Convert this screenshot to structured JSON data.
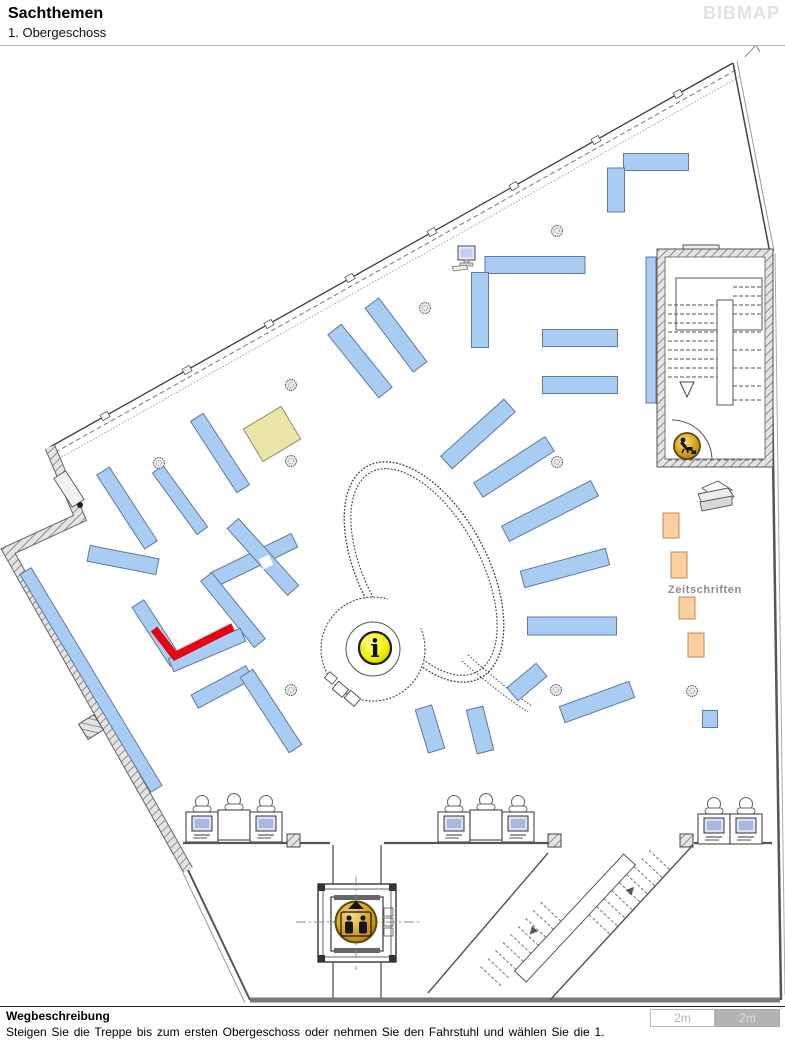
{
  "header": {
    "title": "Sachthemen",
    "subtitle": "1. Obergeschoss",
    "logo": "BIBMAP"
  },
  "footer": {
    "heading": "Wegbeschreibung",
    "instruction": "Steigen Sie die Treppe bis zum ersten Obergeschoss oder nehmen Sie den Fahrstuhl und wählen Sie die 1.",
    "scale_left": "2m",
    "scale_right": "2m"
  },
  "map": {
    "zeitschriften_label": "Zeitschriften",
    "info_glyph": "i",
    "colors": {
      "shelf_fill": "#a9cdf2",
      "shelf_stroke": "#61799c",
      "highlight_red": "#e30613",
      "magazine_fill": "#fbcf9e",
      "special_fill": "#ece5a8",
      "icon_gold": "#d9a61f",
      "info_yellow": "#f0ea00"
    },
    "icons": {
      "info": "info-icon",
      "elevator": "elevator-icon",
      "stairs_person": "person-on-stairs-icon",
      "printer": "copier-icon",
      "computer": "computer-icon"
    },
    "shelves": [
      {
        "x": 220,
        "y": 453,
        "l": 85,
        "w": 15,
        "a": 57
      },
      {
        "x": 127,
        "y": 508,
        "l": 88,
        "w": 15,
        "a": 57
      },
      {
        "x": 123,
        "y": 560,
        "l": 70,
        "w": 16,
        "a": 11
      },
      {
        "x": 180,
        "y": 500,
        "l": 76,
        "w": 13,
        "a": 54
      },
      {
        "x": 254,
        "y": 560,
        "l": 90,
        "w": 15,
        "a": -26
      },
      {
        "x": 263,
        "y": 557,
        "l": 90,
        "w": 15,
        "a": 48
      },
      {
        "x": 233,
        "y": 610,
        "l": 85,
        "w": 14,
        "a": 51
      },
      {
        "x": 157,
        "y": 633,
        "l": 70,
        "w": 14,
        "a": 57
      },
      {
        "x": 207,
        "y": 650,
        "l": 78,
        "w": 14,
        "a": -23
      },
      {
        "x": 222,
        "y": 687,
        "l": 62,
        "w": 15,
        "a": -28
      },
      {
        "x": 271,
        "y": 711,
        "l": 90,
        "w": 15,
        "a": 57
      },
      {
        "x": 91,
        "y": 680,
        "l": 254,
        "w": 13,
        "a": 59
      },
      {
        "x": 656,
        "y": 162,
        "l": 65,
        "w": 17,
        "a": 0
      },
      {
        "x": 616,
        "y": 190,
        "l": 44,
        "w": 17,
        "a": 90
      },
      {
        "x": 535,
        "y": 265,
        "l": 100,
        "w": 17,
        "a": 0
      },
      {
        "x": 480,
        "y": 310,
        "l": 75,
        "w": 17,
        "a": 90
      },
      {
        "x": 580,
        "y": 338,
        "l": 75,
        "w": 17,
        "a": 0
      },
      {
        "x": 580,
        "y": 385,
        "l": 75,
        "w": 17,
        "a": 0
      },
      {
        "x": 651,
        "y": 330,
        "l": 146,
        "w": 10,
        "a": 90
      },
      {
        "x": 360,
        "y": 361,
        "l": 81,
        "w": 17,
        "a": 51
      },
      {
        "x": 396,
        "y": 335,
        "l": 80,
        "w": 17,
        "a": 53
      },
      {
        "x": 478,
        "y": 434,
        "l": 85,
        "w": 17,
        "a": -42
      },
      {
        "x": 514,
        "y": 467,
        "l": 85,
        "w": 17,
        "a": -33
      },
      {
        "x": 550,
        "y": 511,
        "l": 100,
        "w": 17,
        "a": -27
      },
      {
        "x": 565,
        "y": 568,
        "l": 88,
        "w": 17,
        "a": -15
      },
      {
        "x": 572,
        "y": 626,
        "l": 89,
        "w": 18,
        "a": 0
      },
      {
        "x": 527,
        "y": 682,
        "l": 38,
        "w": 17,
        "a": -40
      },
      {
        "x": 597,
        "y": 702,
        "l": 74,
        "w": 17,
        "a": -20
      },
      {
        "x": 430,
        "y": 729,
        "l": 45,
        "w": 17,
        "a": 73
      },
      {
        "x": 480,
        "y": 730,
        "l": 45,
        "w": 17,
        "a": 76
      },
      {
        "x": 710,
        "y": 719,
        "l": 15,
        "w": 17,
        "a": 0
      }
    ],
    "special_shelves": [
      {
        "x": 272,
        "y": 434,
        "l": 44,
        "w": 38,
        "a": -31
      }
    ],
    "cross_gaps": [
      {
        "x": 266,
        "y": 562,
        "l": 11,
        "w": 11,
        "a": -26
      }
    ],
    "highlight": {
      "points": "154,629 175,656 233,627",
      "width": 8
    },
    "magazines": [
      {
        "x": 663,
        "y": 513,
        "w": 16,
        "h": 25
      },
      {
        "x": 671,
        "y": 552,
        "w": 16,
        "h": 26
      },
      {
        "x": 679,
        "y": 597,
        "w": 16,
        "h": 22
      },
      {
        "x": 688,
        "y": 633,
        "w": 16,
        "h": 24
      }
    ],
    "columns": [
      [
        291,
        385
      ],
      [
        159,
        463
      ],
      [
        291,
        461
      ],
      [
        291,
        690
      ],
      [
        557,
        231
      ],
      [
        425,
        308
      ],
      [
        557,
        462
      ],
      [
        556,
        690
      ],
      [
        692,
        691
      ]
    ],
    "workstations": [
      {
        "x": 186,
        "y": 796,
        "monitor": true
      },
      {
        "x": 218,
        "y": 794,
        "monitor": false
      },
      {
        "x": 250,
        "y": 796,
        "monitor": true
      },
      {
        "x": 438,
        "y": 796,
        "monitor": true
      },
      {
        "x": 470,
        "y": 794,
        "monitor": false
      },
      {
        "x": 502,
        "y": 796,
        "monitor": true
      },
      {
        "x": 698,
        "y": 798,
        "monitor": true
      },
      {
        "x": 730,
        "y": 798,
        "monitor": true
      }
    ]
  }
}
